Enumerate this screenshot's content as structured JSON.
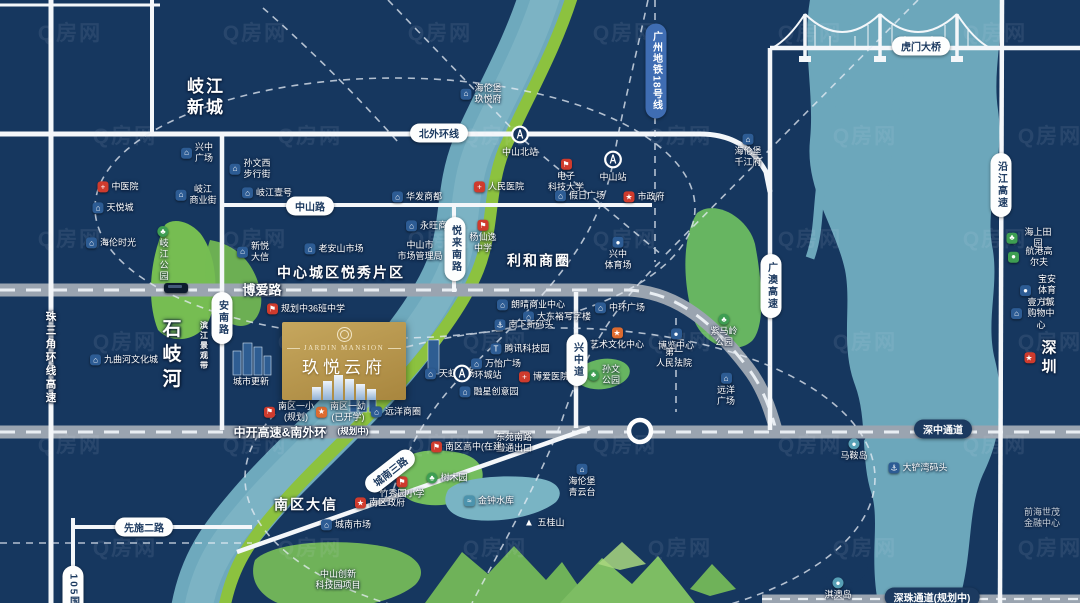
{
  "watermark": {
    "text": "Q房网"
  },
  "colors": {
    "background": "#16375f",
    "river": "#6ea9bd",
    "river_light": "#82b8c8",
    "green_belt": "#8cc23f",
    "park_green": "#6fb259",
    "road_gray": "#9aa4b0",
    "road_white": "#f4f7fa",
    "gold_from": "#c6a75e",
    "gold_to": "#a8863e",
    "metro_blue": "#3f6db3",
    "pill_navy": "#1c3a60",
    "poi_red": "#cf3b2d",
    "poi_blue": "#2d5c94",
    "poi_orange": "#dd6b2f",
    "poi_green": "#3e9e52"
  },
  "property_card": {
    "title_en": "JARDIN MANSION",
    "title_cn": "玖悦云府"
  },
  "road_labels": [
    {
      "n": "zhongshan-road",
      "t": "中山路",
      "x": 310,
      "y": 206,
      "k": "pill"
    },
    {
      "n": "north-outer-ring-road",
      "t": "北外环线",
      "x": 439,
      "y": 133,
      "k": "pill"
    },
    {
      "n": "annan-road",
      "t": "安南路",
      "x": 222,
      "y": 318,
      "k": "pillv"
    },
    {
      "n": "yuelai-south-road",
      "t": "悦来南路",
      "x": 455,
      "y": 249,
      "k": "pillv"
    },
    {
      "n": "xingzhong-road",
      "t": "兴中道",
      "x": 577,
      "y": 360,
      "k": "pillv"
    },
    {
      "n": "guangao-expressway",
      "t": "广澳高速",
      "x": 771,
      "y": 286,
      "k": "pillv"
    },
    {
      "n": "yanjiang-expressway",
      "t": "沿江高速",
      "x": 1001,
      "y": 185,
      "k": "pillv"
    },
    {
      "n": "humen-bridge",
      "t": "虎门大桥",
      "x": 921,
      "y": 46,
      "k": "pill"
    },
    {
      "n": "xianshi-2nd-road",
      "t": "先施二路",
      "x": 144,
      "y": 527,
      "k": "pill"
    },
    {
      "n": "chengnan-3rd-road",
      "t": "城南三路",
      "x": 390,
      "y": 471,
      "k": "pill",
      "rot": -38
    },
    {
      "n": "g105-national-road",
      "t": "105国道",
      "x": 73,
      "y": 597,
      "k": "pillv"
    },
    {
      "n": "guangzhou-metro-line-18",
      "t": "广州地铁18号线",
      "x": 656,
      "y": 71,
      "k": "bluev"
    },
    {
      "n": "boai-road",
      "t": "博爱路",
      "x": 262,
      "y": 289,
      "k": "rtext",
      "fs": 13
    },
    {
      "n": "zhongkai-expwy-south-ring",
      "t": "中开高速&南外环",
      "x": 280,
      "y": 432,
      "k": "rtext",
      "fs": 12
    },
    {
      "n": "zhongkai-planned-note",
      "t": "(规划中)",
      "x": 353,
      "y": 431,
      "k": "rtext",
      "fs": 8.5
    },
    {
      "n": "shenzhong-corridor",
      "t": "深中通道",
      "x": 943,
      "y": 429,
      "k": "pilln"
    },
    {
      "n": "shenzhu-corridor-planned",
      "t": "深珠通道(规划中)",
      "x": 932,
      "y": 597,
      "k": "pilln"
    },
    {
      "n": "shiqi-river",
      "t": "石岐河",
      "x": 170,
      "y": 356,
      "k": "rtextv",
      "fs": 19,
      "ls": 6
    },
    {
      "n": "prd-ring-expressway",
      "t": "珠三角环线高速",
      "x": 51,
      "y": 358,
      "k": "rtextv",
      "fs": 10.5,
      "ls": 3
    },
    {
      "n": "riverside-landscape-belt",
      "t": "滨江景观带",
      "x": 204,
      "y": 346,
      "k": "rtextv",
      "fs": 8,
      "ls": 2
    }
  ],
  "area_labels": [
    {
      "n": "qijiang-new-town",
      "lines": [
        "岐江",
        "新城"
      ],
      "x": 206,
      "y": 97,
      "fs": 17
    },
    {
      "n": "central-yuexiu-district",
      "lines": [
        "中心城区悦秀片区"
      ],
      "x": 341,
      "y": 273,
      "fs": 14
    },
    {
      "n": "lihe-business-circle",
      "lines": [
        "利和商圈"
      ],
      "x": 539,
      "y": 261,
      "fs": 14
    },
    {
      "n": "nanqu-daxin",
      "lines": [
        "南区大信"
      ],
      "x": 306,
      "y": 505,
      "fs": 14
    },
    {
      "n": "shenzhen",
      "lines": [
        "深圳"
      ],
      "x": 1043,
      "y": 358,
      "fs": 15,
      "ic": "gov"
    }
  ],
  "stations": [
    {
      "n": "zhongshan-north-station",
      "label": "中山北站",
      "x": 520,
      "y": 137,
      "lp": "b"
    },
    {
      "n": "zhongshan-station",
      "label": "中山站",
      "x": 613,
      "y": 162,
      "lp": "b"
    },
    {
      "n": "huancheng-station",
      "label": "环城站",
      "x": 462,
      "y": 376,
      "lp": "r"
    }
  ],
  "pois": [
    {
      "n": "tcm-hospital",
      "x": 118,
      "y": 187,
      "ic": "hosp",
      "ip": "l",
      "t": "中医院"
    },
    {
      "n": "tianyue-mall",
      "x": 113,
      "y": 208,
      "ic": "mall",
      "ip": "l",
      "t": "天悦城"
    },
    {
      "n": "xingzhong-plaza",
      "x": 197,
      "y": 153,
      "ic": "mall",
      "ip": "l",
      "lines": [
        "兴中",
        "广场"
      ]
    },
    {
      "n": "sunwen-west-walking-street",
      "x": 250,
      "y": 169,
      "ic": "mall",
      "ip": "l",
      "lines": [
        "孙文西",
        "步行街"
      ]
    },
    {
      "n": "qijiang-business-street",
      "x": 196,
      "y": 195,
      "ic": "mall",
      "ip": "l",
      "lines": [
        "岐江",
        "商业街"
      ]
    },
    {
      "n": "qijiang-no1",
      "x": 267,
      "y": 193,
      "ic": "mall",
      "ip": "l",
      "t": "岐江壹号"
    },
    {
      "n": "hailun-time",
      "x": 111,
      "y": 243,
      "ic": "mall",
      "ip": "l",
      "t": "海伦时光"
    },
    {
      "n": "qijiang-park",
      "x": 163,
      "y": 254,
      "ic": "park",
      "ip": "t",
      "t": "岐江公园",
      "vert": true
    },
    {
      "n": "xinyue-daxin",
      "x": 253,
      "y": 252,
      "ic": "mall",
      "ip": "l",
      "lines": [
        "新悦",
        "大信"
      ]
    },
    {
      "n": "laoanshan-market",
      "x": 334,
      "y": 249,
      "ic": "mall",
      "ip": "l",
      "t": "老安山市场"
    },
    {
      "n": "jiuquhe-culture-city",
      "x": 124,
      "y": 360,
      "ic": "mall",
      "ip": "l",
      "t": "九曲河文化城"
    },
    {
      "n": "urban-renewal",
      "x": 251,
      "y": 382,
      "t": "城市更新"
    },
    {
      "n": "planned-36-class-school",
      "x": 306,
      "y": 309,
      "ic": "school",
      "ip": "l",
      "t": "规划中36班中学"
    },
    {
      "n": "nanqu-primary-planned",
      "x": 289,
      "y": 412,
      "ic": "school",
      "ip": "l",
      "lines": [
        "南区一小",
        "(规划)"
      ]
    },
    {
      "n": "nanqu-kindergarten",
      "x": 341,
      "y": 412,
      "ic": "culture",
      "ip": "l",
      "lines": [
        "南区一幼",
        "(已开学)"
      ]
    },
    {
      "n": "yuanyang-business-circle",
      "x": 396,
      "y": 412,
      "ic": "mall",
      "ip": "l",
      "t": "远洋商圈"
    },
    {
      "n": "rainbow-plaza",
      "x": 450,
      "y": 374,
      "ic": "mall",
      "ip": "l",
      "t": "天虹广场"
    },
    {
      "n": "helenbergh-jiuyuefu",
      "x": 481,
      "y": 94,
      "ic": "dev",
      "ip": "l",
      "lines": [
        "海伦堡",
        "玖悦府"
      ]
    },
    {
      "n": "uestc-zhongshan",
      "x": 566,
      "y": 176,
      "ic": "school",
      "ip": "t",
      "lines": [
        "电子",
        "科技大学"
      ]
    },
    {
      "n": "people-hospital",
      "x": 499,
      "y": 187,
      "ic": "hosp",
      "ip": "l",
      "t": "人民医院"
    },
    {
      "n": "huafa-mall",
      "x": 417,
      "y": 197,
      "ic": "mall",
      "ip": "l",
      "t": "华发商都"
    },
    {
      "n": "holiday-plaza",
      "x": 580,
      "y": 196,
      "ic": "mall",
      "ip": "l",
      "t": "假日广场"
    },
    {
      "n": "city-government",
      "x": 644,
      "y": 197,
      "ic": "gov",
      "ip": "l",
      "t": "市政府"
    },
    {
      "n": "aeon-mall",
      "x": 431,
      "y": 226,
      "ic": "mall",
      "ip": "l",
      "t": "永旺商场"
    },
    {
      "n": "market-admin-bureau",
      "x": 420,
      "y": 251,
      "lines": [
        "中山市",
        "市场管理局"
      ]
    },
    {
      "n": "yangxianyi-middle-school",
      "x": 483,
      "y": 237,
      "ic": "school",
      "ip": "t",
      "lines": [
        "杨仙逸",
        "中学"
      ]
    },
    {
      "n": "xingzhong-stadium",
      "x": 618,
      "y": 254,
      "ic": "stadium",
      "ip": "t",
      "lines": [
        "兴中",
        "体育场"
      ]
    },
    {
      "n": "zimaling-park",
      "x": 724,
      "y": 331,
      "ic": "park",
      "ip": "t",
      "lines": [
        "紫马岭",
        "公园"
      ]
    },
    {
      "n": "langqing-business-center",
      "x": 531,
      "y": 305,
      "ic": "mall",
      "ip": "l",
      "t": "朗晴商业中心"
    },
    {
      "n": "dadongyu-office",
      "x": 557,
      "y": 317,
      "ic": "mall",
      "ip": "l",
      "t": "大东裕写字楼"
    },
    {
      "n": "nanxia-new-wharf",
      "x": 524,
      "y": 325,
      "ic": "port",
      "ip": "l",
      "t": "南下新码头"
    },
    {
      "n": "tencent-tech-park",
      "x": 520,
      "y": 349,
      "ic": "tech",
      "ip": "l",
      "t": "腾讯科技园"
    },
    {
      "n": "wanyi-plaza",
      "x": 496,
      "y": 364,
      "ic": "mall",
      "ip": "l",
      "t": "万怡广场"
    },
    {
      "n": "boai-hospital",
      "x": 544,
      "y": 377,
      "ic": "hosp",
      "ip": "l",
      "t": "博爱医院"
    },
    {
      "n": "rongxing-creative-park",
      "x": 489,
      "y": 392,
      "ic": "mall",
      "ip": "l",
      "t": "融星创意园"
    },
    {
      "n": "zhonghuan-plaza",
      "x": 620,
      "y": 308,
      "ic": "mall",
      "ip": "l",
      "t": "中环广场"
    },
    {
      "n": "art-culture-center",
      "x": 617,
      "y": 339,
      "ic": "culture",
      "ip": "t",
      "t": "艺术文化中心"
    },
    {
      "n": "sunwen-park",
      "x": 604,
      "y": 375,
      "ic": "park",
      "ip": "l",
      "lines": [
        "孙文",
        "公园"
      ]
    },
    {
      "n": "expo-center",
      "x": 676,
      "y": 340,
      "ic": "stadium",
      "ip": "t",
      "t": "博览中心"
    },
    {
      "n": "first-people-court",
      "x": 674,
      "y": 358,
      "lines": [
        "第一",
        "人民法院"
      ]
    },
    {
      "n": "yuanyang-plaza",
      "x": 726,
      "y": 390,
      "ic": "mall",
      "ip": "t",
      "lines": [
        "远洋",
        "广场"
      ]
    },
    {
      "n": "dongyuan-south-interchange",
      "x": 514,
      "y": 443,
      "lines": [
        "东苑南路",
        "互通出口"
      ]
    },
    {
      "n": "nanqu-government",
      "x": 380,
      "y": 503,
      "ic": "gov",
      "ip": "l",
      "t": "南区政府"
    },
    {
      "n": "chengnan-market",
      "x": 346,
      "y": 525,
      "ic": "mall",
      "ip": "l",
      "t": "城南市场"
    },
    {
      "n": "zhuxiuyuan-primary",
      "x": 402,
      "y": 488,
      "ic": "school",
      "ip": "t",
      "t": "竹秀园小学"
    },
    {
      "n": "nanqu-high-school",
      "x": 468,
      "y": 447,
      "ic": "school",
      "ip": "l",
      "t": "南区高中(在建)"
    },
    {
      "n": "arboretum",
      "x": 447,
      "y": 478,
      "ic": "park",
      "ip": "l",
      "t": "树木园"
    },
    {
      "n": "jinzhong-reservoir",
      "x": 489,
      "y": 501,
      "ic": "water",
      "ip": "l",
      "t": "金钟水库"
    },
    {
      "n": "wuguishan-mountain",
      "x": 544,
      "y": 523,
      "ic": "mountain",
      "ip": "l",
      "t": "五桂山"
    },
    {
      "n": "helenbergh-qingyuntai",
      "x": 582,
      "y": 481,
      "ic": "dev",
      "ip": "t",
      "lines": [
        "海伦堡",
        "青云台"
      ]
    },
    {
      "n": "innovation-tech-park",
      "x": 338,
      "y": 580,
      "lines": [
        "中山创新",
        "科技园项目"
      ]
    },
    {
      "n": "helenbergh-qianjiangfu",
      "x": 748,
      "y": 151,
      "ic": "dev",
      "ip": "t",
      "lines": [
        "海伦堡",
        "千江府"
      ]
    },
    {
      "n": "haishang-tianyuan",
      "x": 1031,
      "y": 238,
      "ic": "park2",
      "ip": "l",
      "t": "海上田园"
    },
    {
      "n": "hanggang-golf",
      "x": 1032,
      "y": 257,
      "ic": "golf",
      "ip": "l",
      "t": "航港高尔夫"
    },
    {
      "n": "baoan-stadium",
      "x": 1040,
      "y": 291,
      "ic": "stadium",
      "ip": "l",
      "t": "宝安体育馆"
    },
    {
      "n": "yifangcheng-mall",
      "x": 1034,
      "y": 314,
      "ic": "mall",
      "ip": "l",
      "lines": [
        "壹方城",
        "购物中心"
      ]
    },
    {
      "n": "qianhai-shimao-financial-center",
      "x": 1042,
      "y": 518,
      "lines": [
        "前海世茂",
        "金融中心"
      ],
      "dim": true
    },
    {
      "n": "maan-island",
      "x": 854,
      "y": 450,
      "ic": "island",
      "ip": "t",
      "t": "马鞍岛"
    },
    {
      "n": "dachanwan-wharf",
      "x": 918,
      "y": 468,
      "ic": "port",
      "ip": "l",
      "t": "大铲湾码头"
    },
    {
      "n": "qiao-island",
      "x": 838,
      "y": 589,
      "ic": "island",
      "ip": "t",
      "t": "淇澳岛"
    }
  ]
}
